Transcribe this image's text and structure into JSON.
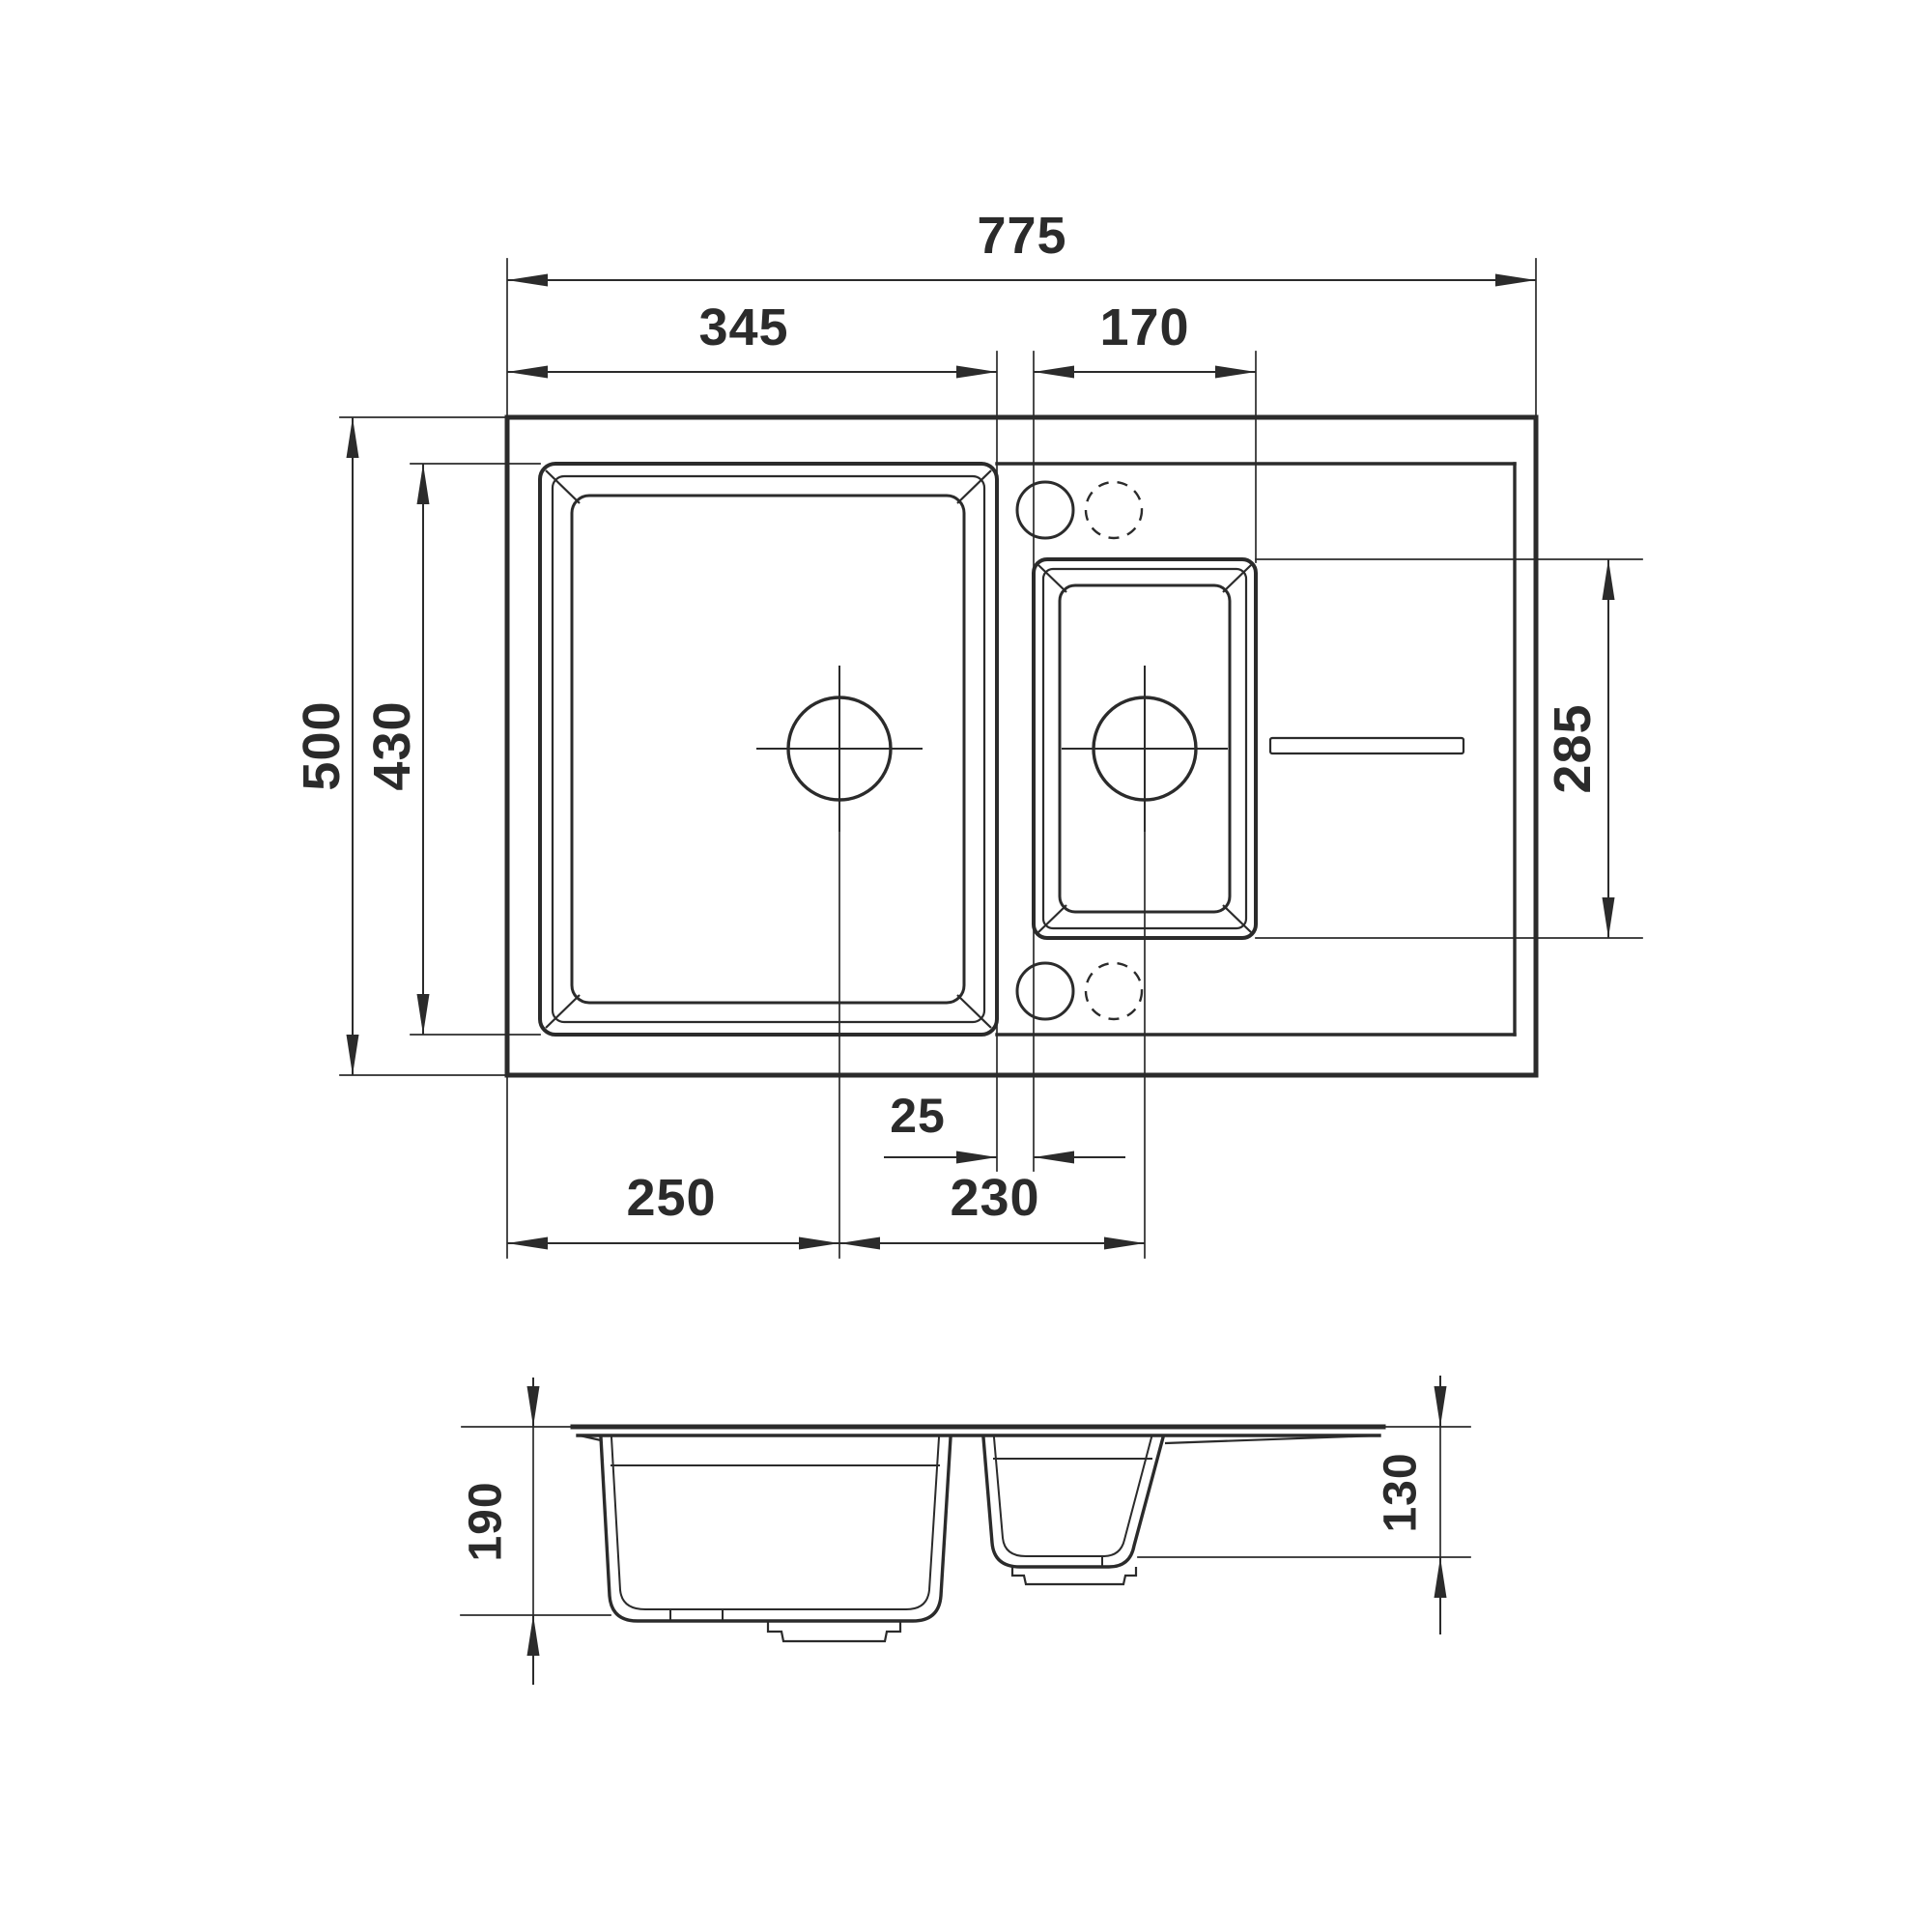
{
  "drawing": {
    "kind": "technical-dimension-drawing",
    "subject": "kitchen sink with one and a half bowls and drainboard",
    "colors": {
      "line": "#2b2b2b",
      "background": "#ffffff"
    },
    "views": {
      "top": {
        "label": "top view",
        "dims": {
          "overall_width": "775",
          "main_bowl_width": "345",
          "second_bowl_width": "170",
          "overall_depth": "500",
          "main_bowl_depth": "430",
          "second_bowl_length": "285",
          "bowl_gap": "25",
          "main_drain_from_left": "250",
          "drain_to_drain": "230"
        }
      },
      "side": {
        "label": "side section view",
        "dims": {
          "main_bowl_height": "190",
          "second_bowl_height": "130"
        }
      }
    }
  }
}
